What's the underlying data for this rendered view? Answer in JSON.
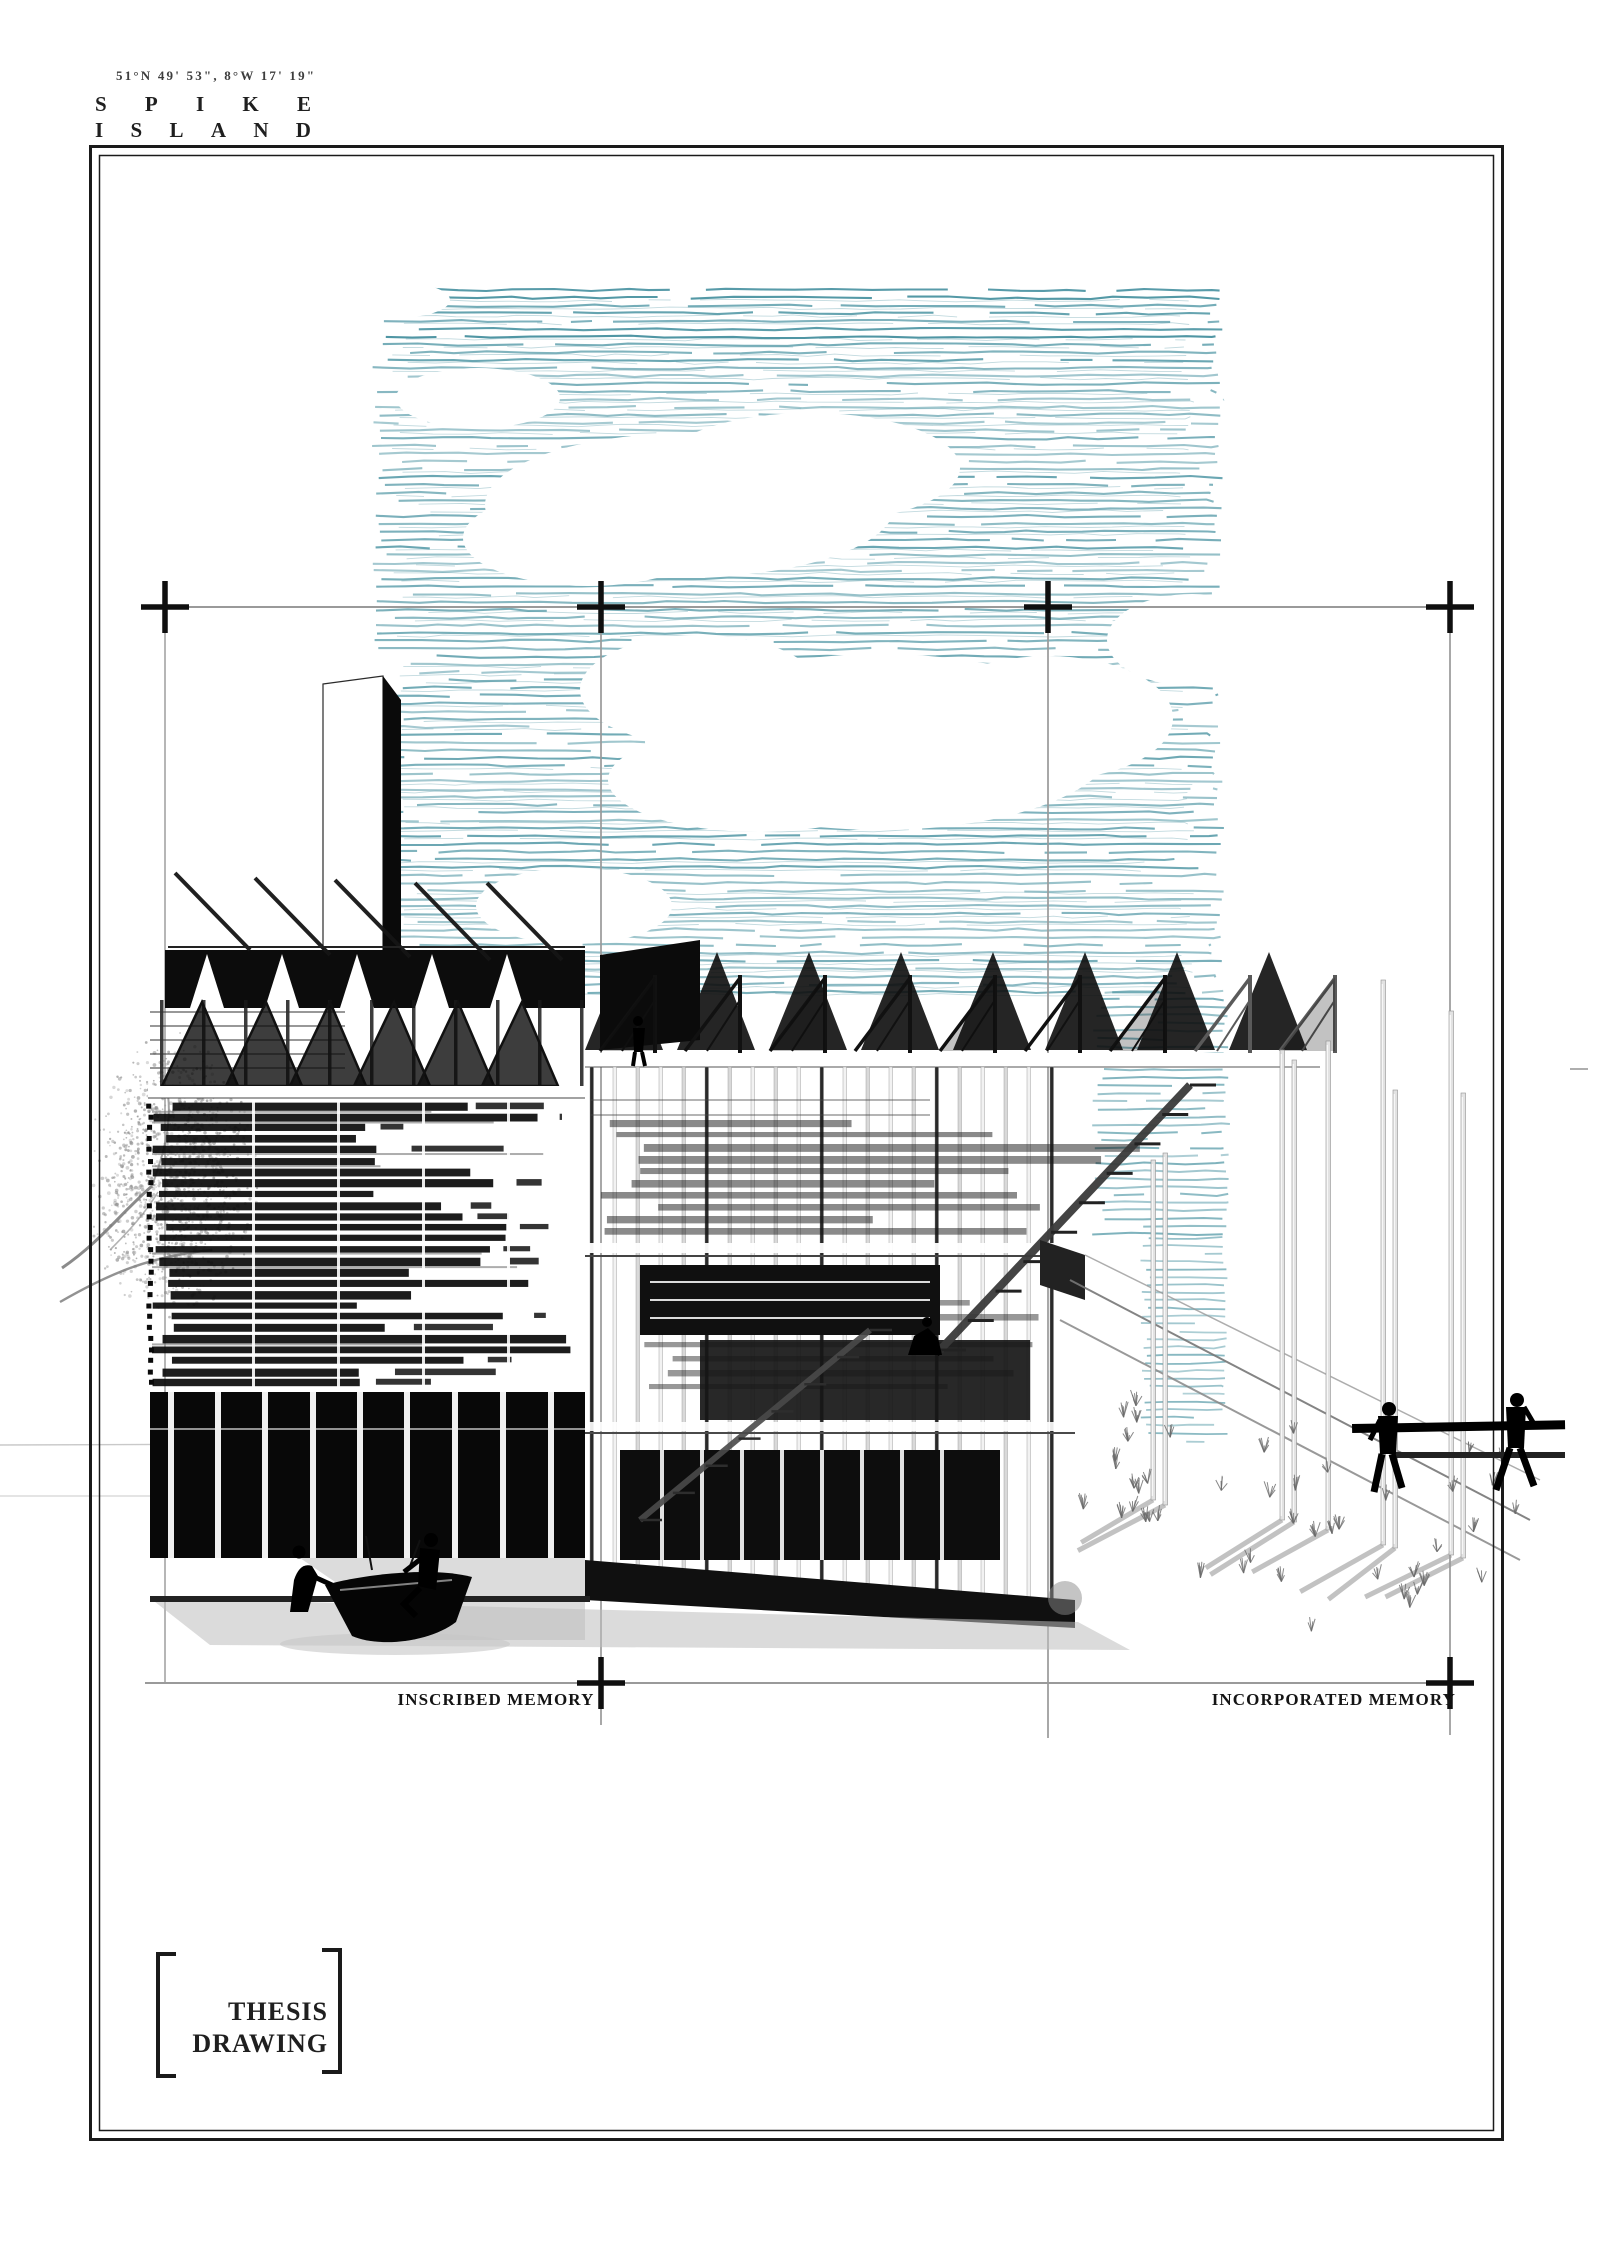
{
  "page": {
    "width": 1600,
    "height": 2266,
    "background": "#ffffff"
  },
  "header": {
    "coordinates": "51°N 49' 53\", 8°W 17' 19\"",
    "title_line1": "SPIKE",
    "title_line2": "ISLAND"
  },
  "section_labels": {
    "left": "INSCRIBED MEMORY",
    "right": "INCORPORATED MEMORY"
  },
  "stamp": {
    "line1": "THESIS",
    "line2": "DRAWING"
  },
  "palette": {
    "sky_hatch": "#4f96a4",
    "ink": "#111111",
    "frame": "#1a1a1a",
    "registration": "#9a9a9a",
    "shadow": "#9b9b9b"
  },
  "scene": {
    "type": "architectural perspective drawing",
    "figures": [
      "boat-builders",
      "stair-climber",
      "crouching-worker",
      "beam-carriers"
    ]
  }
}
